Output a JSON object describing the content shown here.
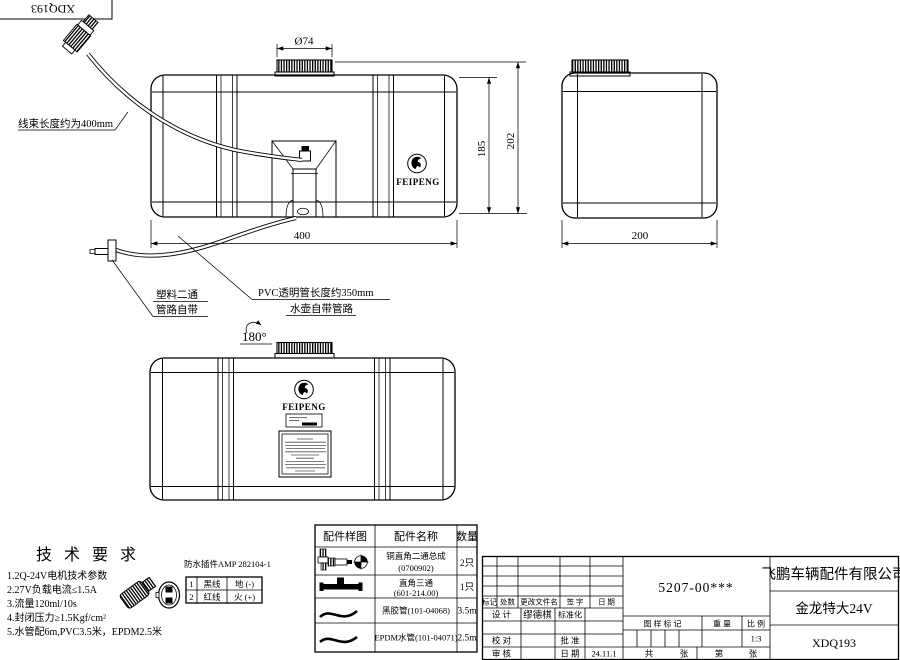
{
  "colors": {
    "line": "#000000",
    "background": "#ffffff"
  },
  "corner": {
    "code": "XDQ193"
  },
  "views": {
    "logo": "FEIPENG",
    "harness_note": "线束长度约为400mm",
    "plastic_note_1": "塑料二通",
    "plastic_note_2": "管路自带",
    "pvc_note_1": "PVC透明管长度约350mm",
    "pvc_note_2": "水壶自带管路",
    "rotate_note": "180°",
    "dims": {
      "cap": "Ø74",
      "h_inner": "185",
      "h_total": "202",
      "width": "400",
      "depth": "200"
    }
  },
  "tech": {
    "title": "技 术 要 求",
    "items": [
      "1.2Q-24V电机技术参数",
      "2.27V负载电流≤1.5A",
      "3.流量120ml/10s",
      "4.封闭压力≥1.5Kgf/cm²",
      "5.水管配6m,PVC3.5米，EPDM2.5米"
    ],
    "connector_title": "防水插件AMP 282104-1",
    "pin_table": {
      "rows": [
        {
          "no": "1",
          "wire": "黑线",
          "signal": "地 (-)"
        },
        {
          "no": "2",
          "wire": "红线",
          "signal": "火 (+)"
        }
      ]
    }
  },
  "parts": {
    "headers": [
      "配件样图",
      "配件名称",
      "数量"
    ],
    "rows": [
      {
        "name": "铜直角二通总成",
        "code": "(0700902)",
        "qty": "2只"
      },
      {
        "name": "直角三通",
        "code": "(601-214.00)",
        "qty": "1只"
      },
      {
        "name": "黑胶管(101-04068)",
        "code": "",
        "qty": "3.5m"
      },
      {
        "name": "EPDM水管(101-04071)",
        "code": "",
        "qty": "2.5m"
      }
    ]
  },
  "titleblock": {
    "part_no": "5207-00***",
    "company": "飞鹏车辆配件有限公司",
    "product": "金龙特大24V",
    "code": "XDQ193",
    "rev": {
      "mark": "标记",
      "count": "处数",
      "file": "更改文件名",
      "sign": "签 字",
      "date": "日 期"
    },
    "design": "设 计",
    "designer": "缪德棋",
    "standard": "标准化",
    "check": "校 对",
    "approve": "批 准",
    "audit": "审 核",
    "date_label": "日 期",
    "date": "24.11.1",
    "stamp": "图 样 标 记",
    "weight": "重 量",
    "scale": "比 例",
    "scale_val": "1:3",
    "total": "共",
    "sheet": "张",
    "page": "第",
    "sheet2": "张"
  }
}
